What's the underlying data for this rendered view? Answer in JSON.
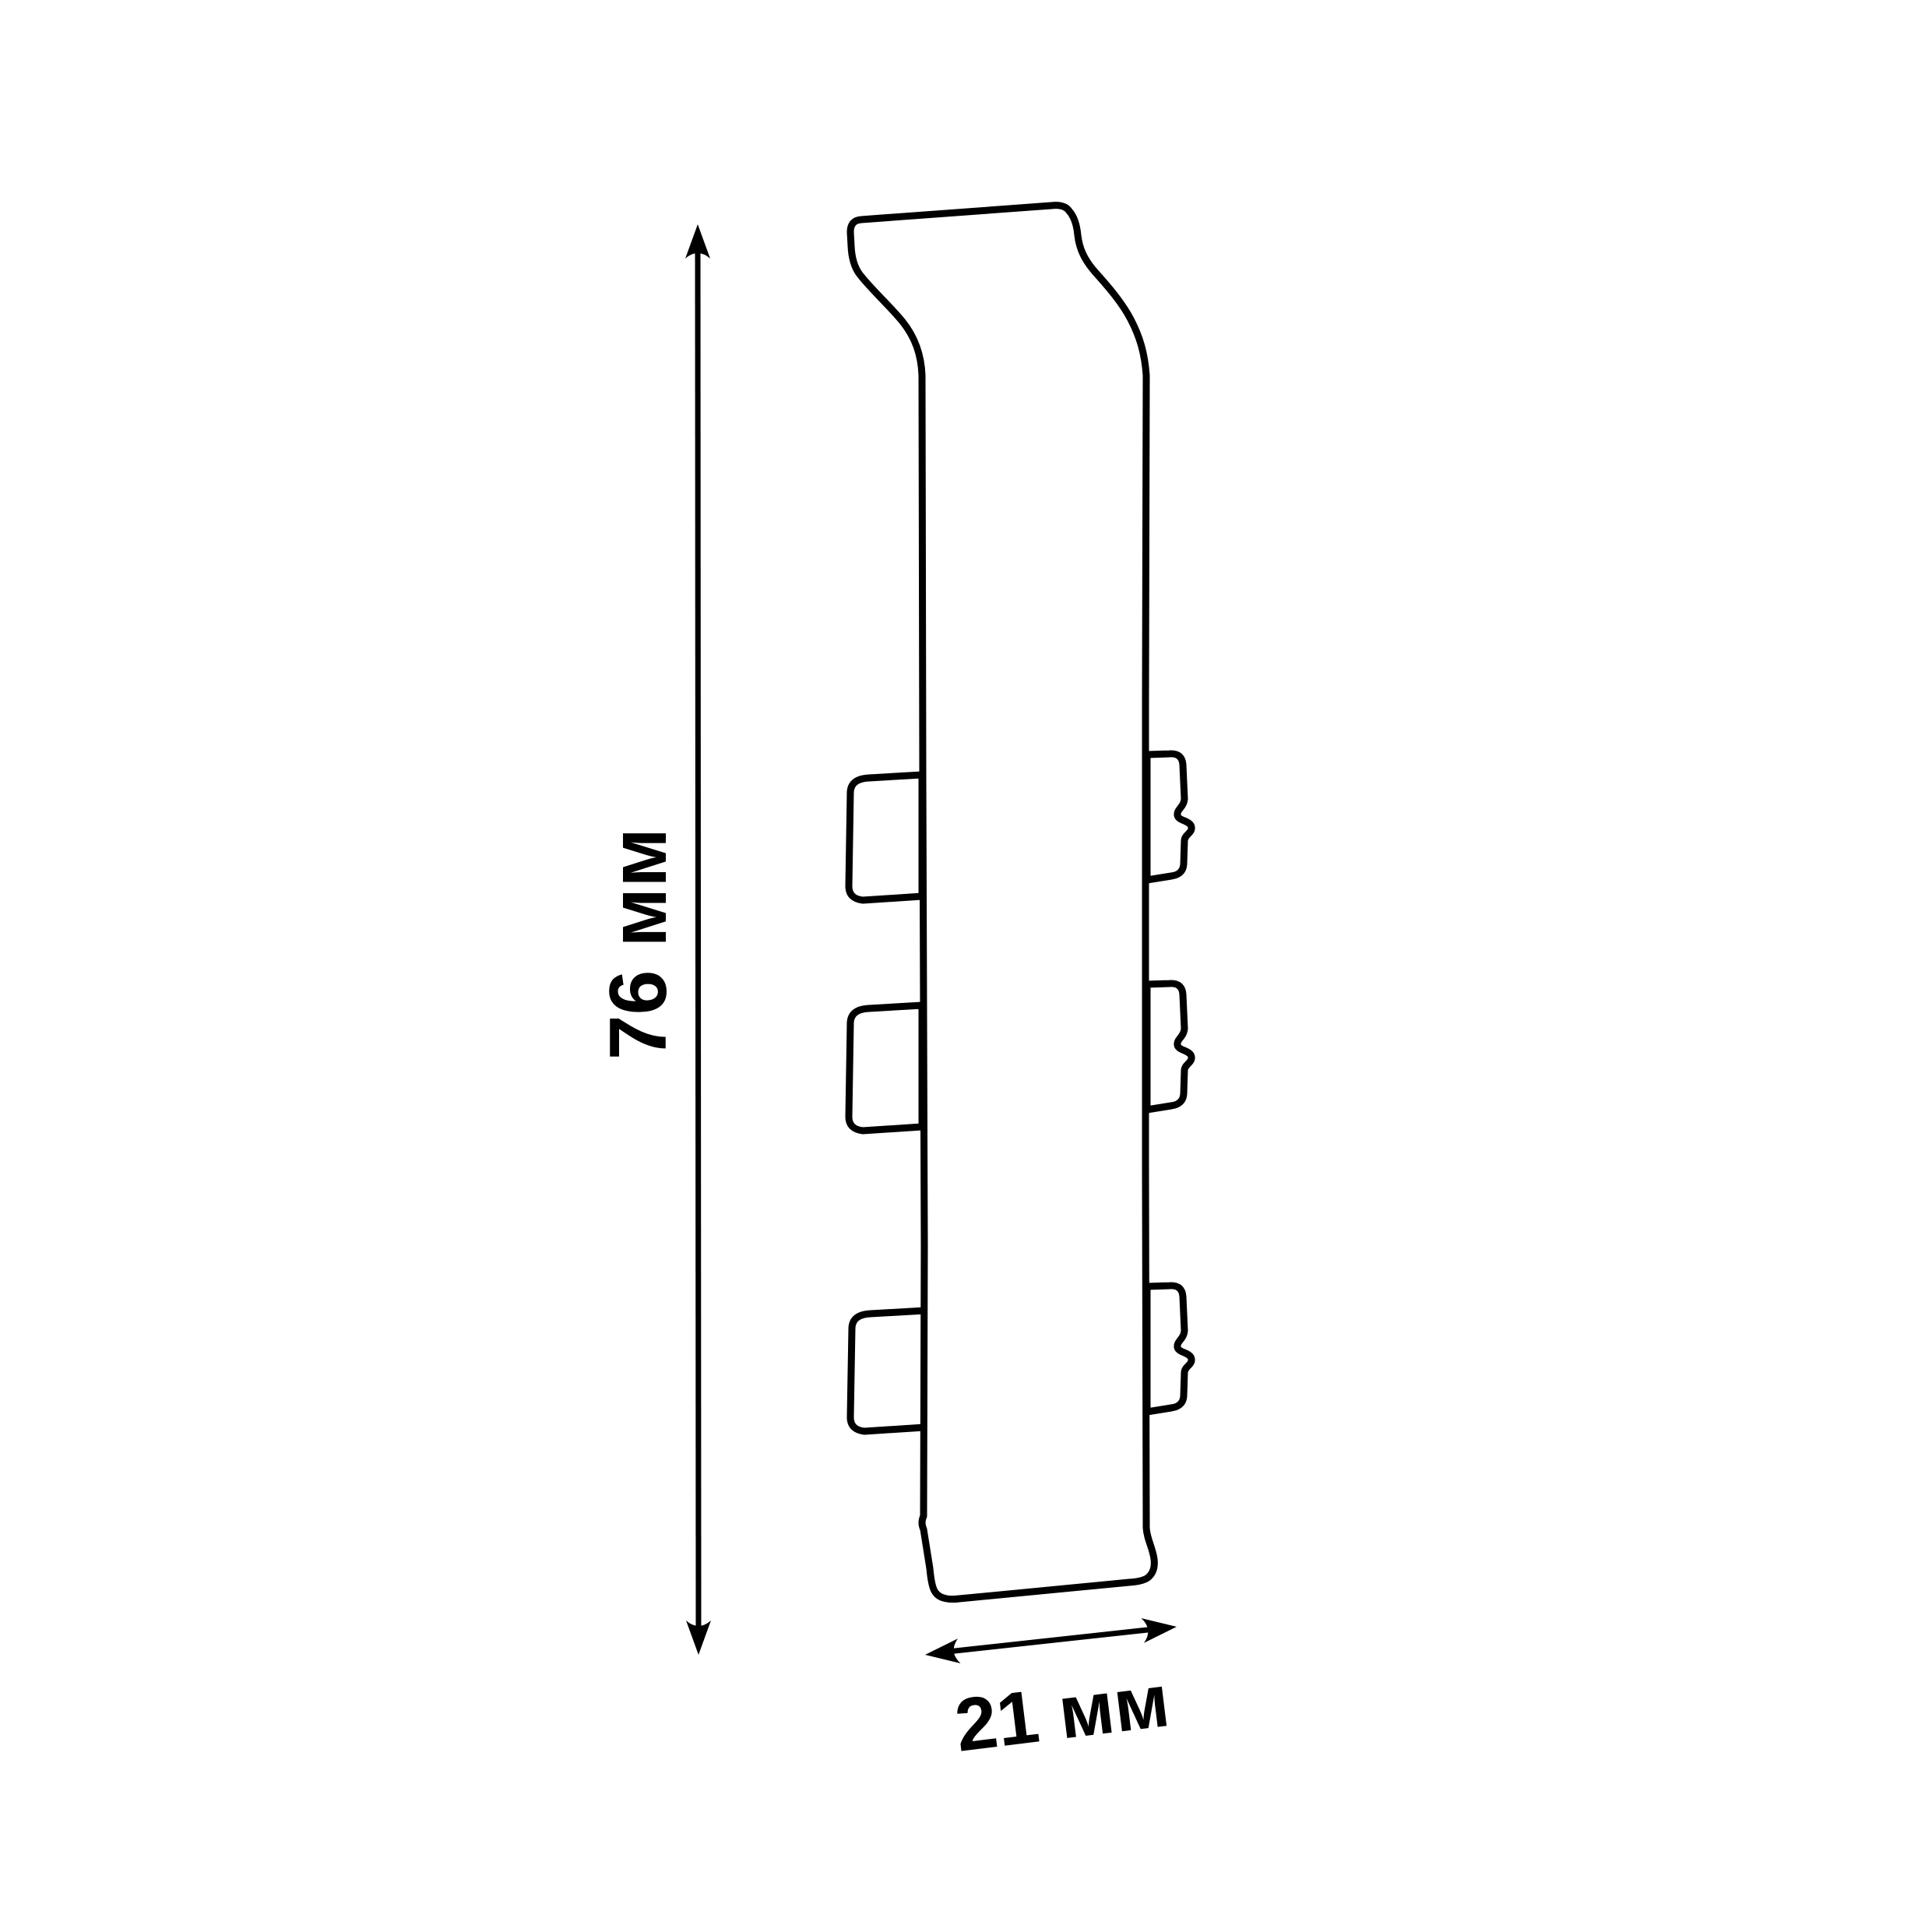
{
  "colors": {
    "background": "#ffffff",
    "line": "#000000"
  },
  "dimensions": {
    "height": {
      "value": 76,
      "unit": "мм",
      "label": "76 мм"
    },
    "width": {
      "value": 21,
      "unit": "мм",
      "label": "21 мм"
    }
  }
}
